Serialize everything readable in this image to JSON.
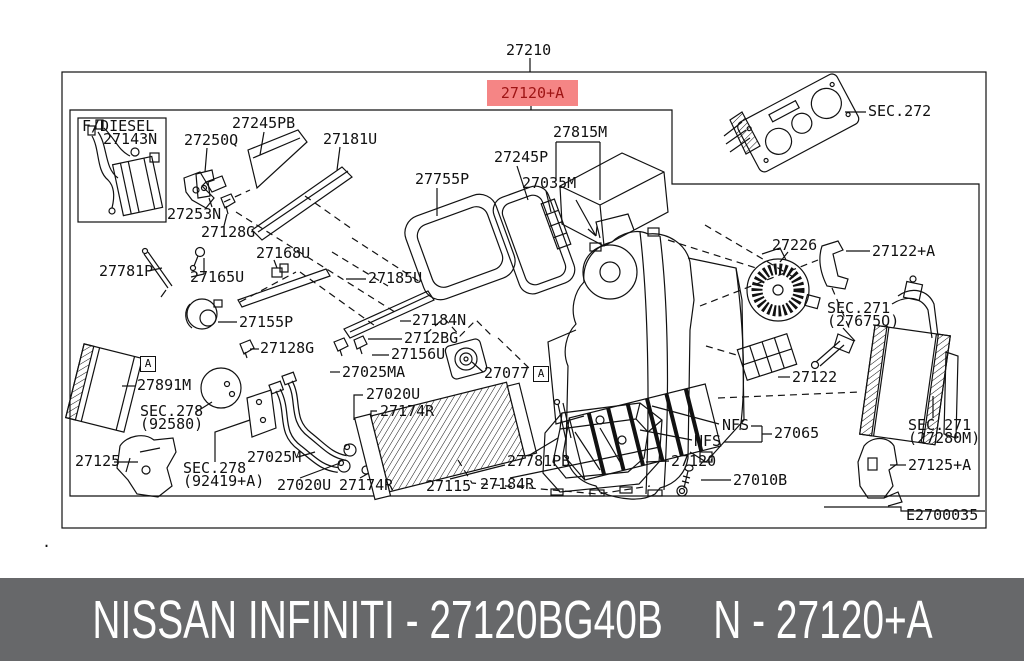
{
  "colors": {
    "highlight_bg": "#f58585",
    "highlight_text": "#9e1414",
    "banner_bg": "#67686a",
    "banner_text": "#ffffff",
    "line": "#111111"
  },
  "header": {
    "assembly_code": "27210"
  },
  "highlight": {
    "code": "27120+A"
  },
  "banner": {
    "left": "NISSAN INFINITI - 27120BG40B",
    "right": "N - 27120+A"
  },
  "diagram": {
    "code_box": "E2700035",
    "labels": [
      {
        "text": "27210",
        "x": 506,
        "y": 44,
        "name": "assembly-code-label"
      },
      {
        "text": "F/DIESEL",
        "x": 82,
        "y": 120,
        "name": "fdiesel-caption"
      },
      {
        "text": "27143N",
        "x": 103,
        "y": 133,
        "name": "part-label-27143n"
      },
      {
        "text": "27245PB",
        "x": 232,
        "y": 117,
        "name": "part-label-27245pb"
      },
      {
        "text": "27250Q",
        "x": 184,
        "y": 134,
        "name": "part-label-27250q"
      },
      {
        "text": "27181U",
        "x": 323,
        "y": 133,
        "name": "part-label-27181u"
      },
      {
        "text": "27253N",
        "x": 167,
        "y": 208,
        "name": "part-label-27253n"
      },
      {
        "text": "27128G",
        "x": 201,
        "y": 226,
        "name": "part-label-27128g"
      },
      {
        "text": "27755P",
        "x": 415,
        "y": 173,
        "name": "part-label-27755p"
      },
      {
        "text": "27245P",
        "x": 494,
        "y": 151,
        "name": "part-label-27245p"
      },
      {
        "text": "27035M",
        "x": 522,
        "y": 177,
        "name": "part-label-27035m"
      },
      {
        "text": "27815M",
        "x": 553,
        "y": 126,
        "name": "part-label-27815m"
      },
      {
        "text": "SEC.272",
        "x": 868,
        "y": 105,
        "name": "part-label-sec272"
      },
      {
        "text": "27781P",
        "x": 99,
        "y": 265,
        "name": "part-label-27781p"
      },
      {
        "text": "27165U",
        "x": 190,
        "y": 271,
        "name": "part-label-27165u"
      },
      {
        "text": "27168U",
        "x": 256,
        "y": 247,
        "name": "part-label-27168u"
      },
      {
        "text": "27155P",
        "x": 239,
        "y": 316,
        "name": "part-label-27155p"
      },
      {
        "text": "27128G",
        "x": 260,
        "y": 342,
        "name": "part-label-27128g-2"
      },
      {
        "text": "27185U",
        "x": 368,
        "y": 272,
        "name": "part-label-27185u"
      },
      {
        "text": "27184N",
        "x": 412,
        "y": 314,
        "name": "part-label-27184n"
      },
      {
        "text": "2712BG",
        "x": 404,
        "y": 332,
        "name": "part-label-2712bg"
      },
      {
        "text": "27156U",
        "x": 391,
        "y": 348,
        "name": "part-label-27156u"
      },
      {
        "text": "27025MA",
        "x": 342,
        "y": 366,
        "name": "part-label-27025ma"
      },
      {
        "text": "27077",
        "x": 484,
        "y": 367,
        "name": "part-label-27077"
      },
      {
        "text": "A",
        "x": 533,
        "y": 366,
        "boxed": true,
        "name": "ref-marker-a"
      },
      {
        "text": "A",
        "x": 140,
        "y": 356,
        "boxed": true,
        "name": "ref-marker-a"
      },
      {
        "text": "27226",
        "x": 772,
        "y": 239,
        "name": "part-label-27226"
      },
      {
        "text": "27122+A",
        "x": 872,
        "y": 245,
        "name": "part-label-27122a"
      },
      {
        "text": "SEC.271\n(27675Q)",
        "x": 827,
        "y": 302,
        "name": "part-label-sec271-27675q"
      },
      {
        "text": "27122",
        "x": 792,
        "y": 371,
        "name": "part-label-27122"
      },
      {
        "text": "27891M",
        "x": 137,
        "y": 379,
        "name": "part-label-27891m"
      },
      {
        "text": "SEC.278\n(92580)",
        "x": 140,
        "y": 405,
        "name": "part-label-sec278-92580"
      },
      {
        "text": "27125",
        "x": 75,
        "y": 455,
        "name": "part-label-27125"
      },
      {
        "text": "SEC.278\n(92419+A)",
        "x": 183,
        "y": 462,
        "name": "part-label-sec278-92419a"
      },
      {
        "text": "27025M",
        "x": 247,
        "y": 451,
        "name": "part-label-27025m"
      },
      {
        "text": "27020U",
        "x": 366,
        "y": 388,
        "name": "part-label-27020u"
      },
      {
        "text": "27174R",
        "x": 380,
        "y": 405,
        "name": "part-label-27174r"
      },
      {
        "text": "27020U",
        "x": 277,
        "y": 479,
        "name": "part-label-27020u-2"
      },
      {
        "text": "27174R",
        "x": 339,
        "y": 479,
        "name": "part-label-27174r-2"
      },
      {
        "text": "27115",
        "x": 426,
        "y": 480,
        "name": "part-label-27115"
      },
      {
        "text": "27184R",
        "x": 480,
        "y": 478,
        "name": "part-label-27184r"
      },
      {
        "text": "27781PB",
        "x": 507,
        "y": 455,
        "name": "part-label-27781pb"
      },
      {
        "text": "27120",
        "x": 671,
        "y": 455,
        "name": "part-label-27120"
      },
      {
        "text": "27010B",
        "x": 733,
        "y": 474,
        "name": "part-label-27010b"
      },
      {
        "text": "NFS",
        "x": 722,
        "y": 419,
        "name": "nfs-label"
      },
      {
        "text": "NFS",
        "x": 694,
        "y": 435,
        "name": "nfs-label-2"
      },
      {
        "text": "27065",
        "x": 774,
        "y": 427,
        "name": "part-label-27065"
      },
      {
        "text": "SEC.271\n(27280M)",
        "x": 908,
        "y": 419,
        "name": "part-label-sec271-27280m"
      },
      {
        "text": "27125+A",
        "x": 908,
        "y": 459,
        "name": "part-label-27125a"
      },
      {
        "text": "E2700035",
        "x": 906,
        "y": 509,
        "name": "diagram-code"
      },
      {
        "text": ".",
        "x": 42,
        "y": 536,
        "name": "stray-dot"
      }
    ]
  }
}
